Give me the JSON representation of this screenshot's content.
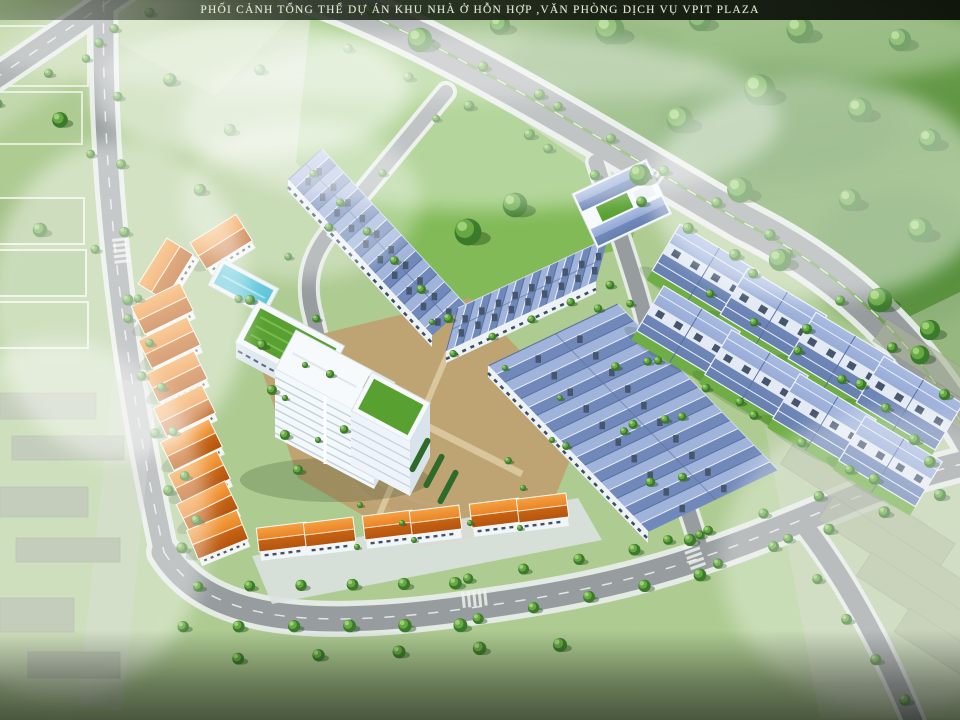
{
  "header": {
    "title": "PHỐI CẢNH TỔNG THỂ DỰ ÁN KHU NHÀ Ở HỖN HỢP ,VĂN PHÒNG DỊCH VỤ VPIT PLAZA"
  },
  "image": {
    "kind": "aerial-architectural-rendering",
    "project_name": "VPIT PLAZA",
    "width_px": 960,
    "height_px": 720
  },
  "colors": {
    "title_bar": "#141b0f",
    "title_text": "#e3e9d4",
    "grass_light": "#aecb92",
    "lawn": "#82ba58",
    "forest": "#67a047",
    "road": "#979d9e",
    "sidewalk": "#e7ece9",
    "plaza": "#bfa172",
    "pool": "#5fc6d9",
    "roof_garden": "#58a030",
    "roof_orange": "#e08226",
    "roof_blue": "#8099c8",
    "building_white": "#f6fafc"
  }
}
